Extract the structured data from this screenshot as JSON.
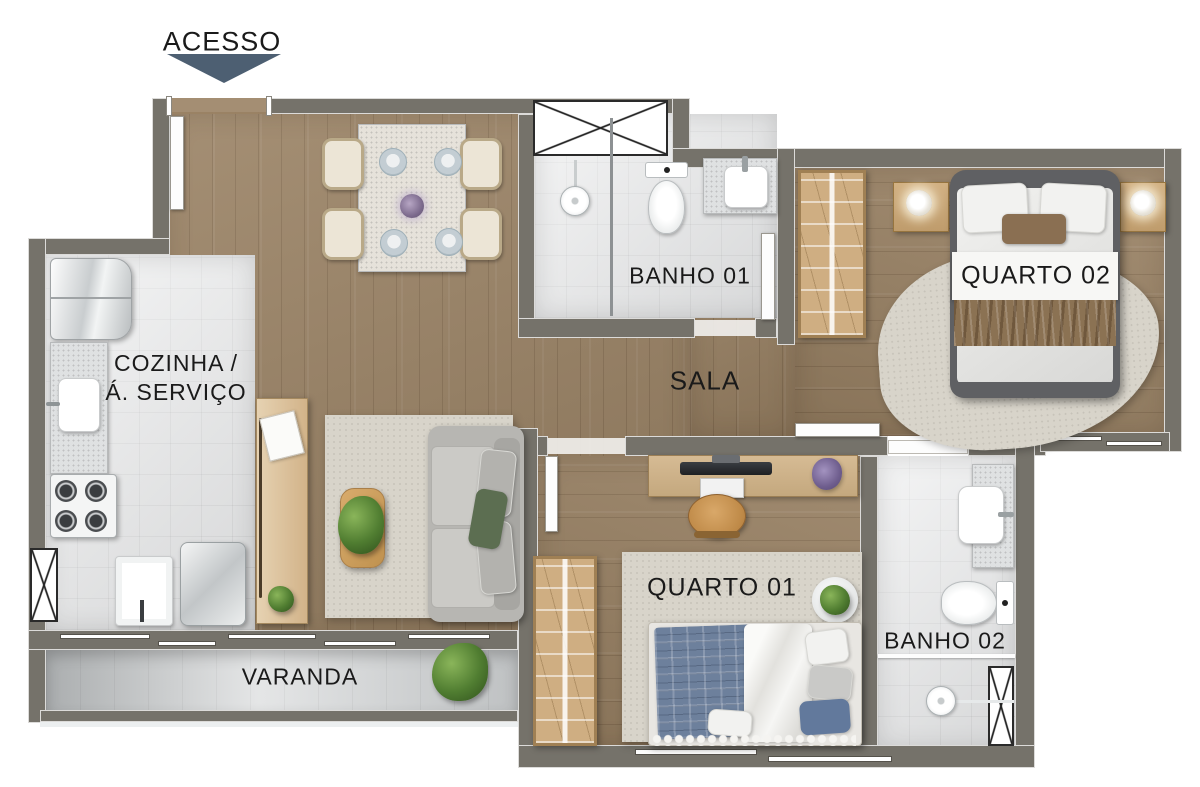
{
  "access": {
    "label": "ACESSO"
  },
  "rooms": {
    "kitchen": {
      "line1": "COZINHA /",
      "line2": "Á. SERVIÇO"
    },
    "living_room": {
      "label": "SALA"
    },
    "bathroom_1": {
      "label": "BANHO 01"
    },
    "bedroom_2": {
      "label": "QUARTO 02"
    },
    "bedroom_1": {
      "label": "QUARTO 01"
    },
    "bathroom_2": {
      "label": "BANHO 02"
    },
    "balcony": {
      "label": "VARANDA"
    }
  },
  "colors": {
    "wall": "#75726a",
    "wood": "#9a8264",
    "tile": "#e7e8e9",
    "varanda": "#d6d8d9",
    "rug": "#d8d4ca",
    "accent_arrow": "#4d5f72",
    "label_text": "#1a1a1a",
    "furn_wood": "#cdb089",
    "bed_frame": "#5f6063",
    "blue_blanket": "#6d809c",
    "green_pillow": "#5c6e51",
    "throw_brown": "#8b7253"
  }
}
